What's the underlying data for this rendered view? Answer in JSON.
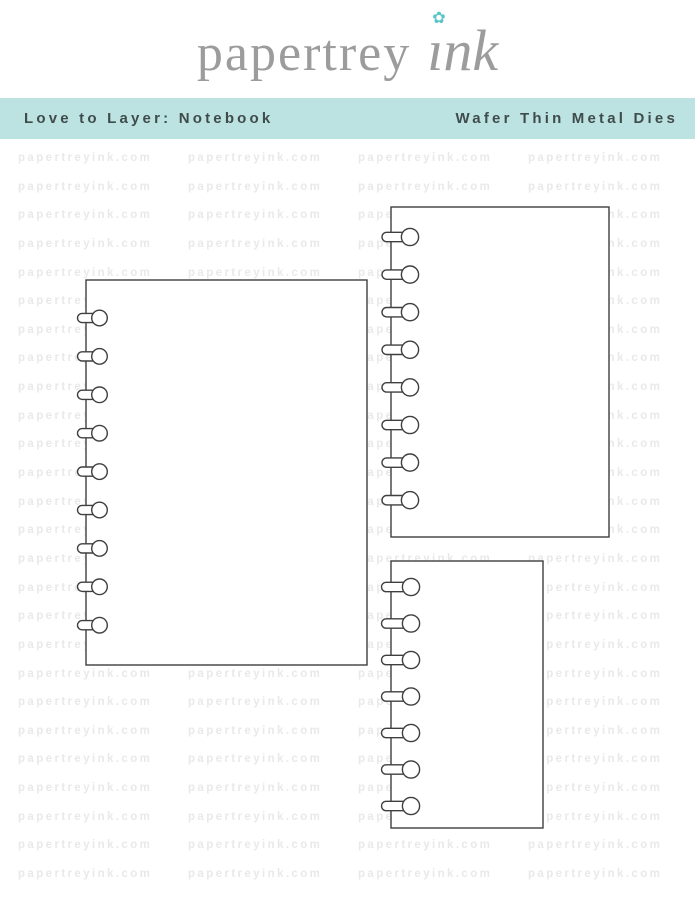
{
  "brand": {
    "wordmark": "papertrey",
    "suffix": "ınk",
    "flower_glyph": "✿",
    "wordmark_color": "#9c9c9c",
    "flower_color": "#59c5c8"
  },
  "banner": {
    "product_name": "Love to Layer: Notebook",
    "product_type": "Wafer Thin Metal Dies",
    "background_color": "#bce2e1",
    "text_color": "#3f4c4c"
  },
  "watermark": {
    "text": "papertreyink.com",
    "color": "#e9e9e9",
    "rows": 26,
    "row_spacing": 28.64,
    "start_y": 151,
    "columns": 5,
    "column_width": 170,
    "left_offset": 18
  },
  "dies": {
    "outline_color": "#3f3f3f",
    "fill_color": "#ffffff",
    "stroke_width": 1.4,
    "shapes": [
      {
        "name": "die-notebook-page-large",
        "x": 86,
        "y": 280,
        "width": 281,
        "height": 385,
        "holes": 9,
        "first_hole_y": 318,
        "hole_spacing": 38.4,
        "hole_radius": 7.8,
        "neck_half": 4.6,
        "neck_left": 8.5,
        "circle_offset": 13.5
      },
      {
        "name": "die-notebook-page-medium",
        "x": 391,
        "y": 207,
        "width": 218,
        "height": 330,
        "holes": 8,
        "first_hole_y": 237,
        "hole_spacing": 37.6,
        "hole_radius": 8.6,
        "neck_half": 4.7,
        "neck_left": 9.0,
        "circle_offset": 19
      },
      {
        "name": "die-notebook-page-small",
        "x": 391,
        "y": 561,
        "width": 152,
        "height": 267,
        "holes": 7,
        "first_hole_y": 587,
        "hole_spacing": 36.5,
        "hole_radius": 8.6,
        "neck_half": 4.7,
        "neck_left": 9.5,
        "circle_offset": 20
      }
    ]
  }
}
